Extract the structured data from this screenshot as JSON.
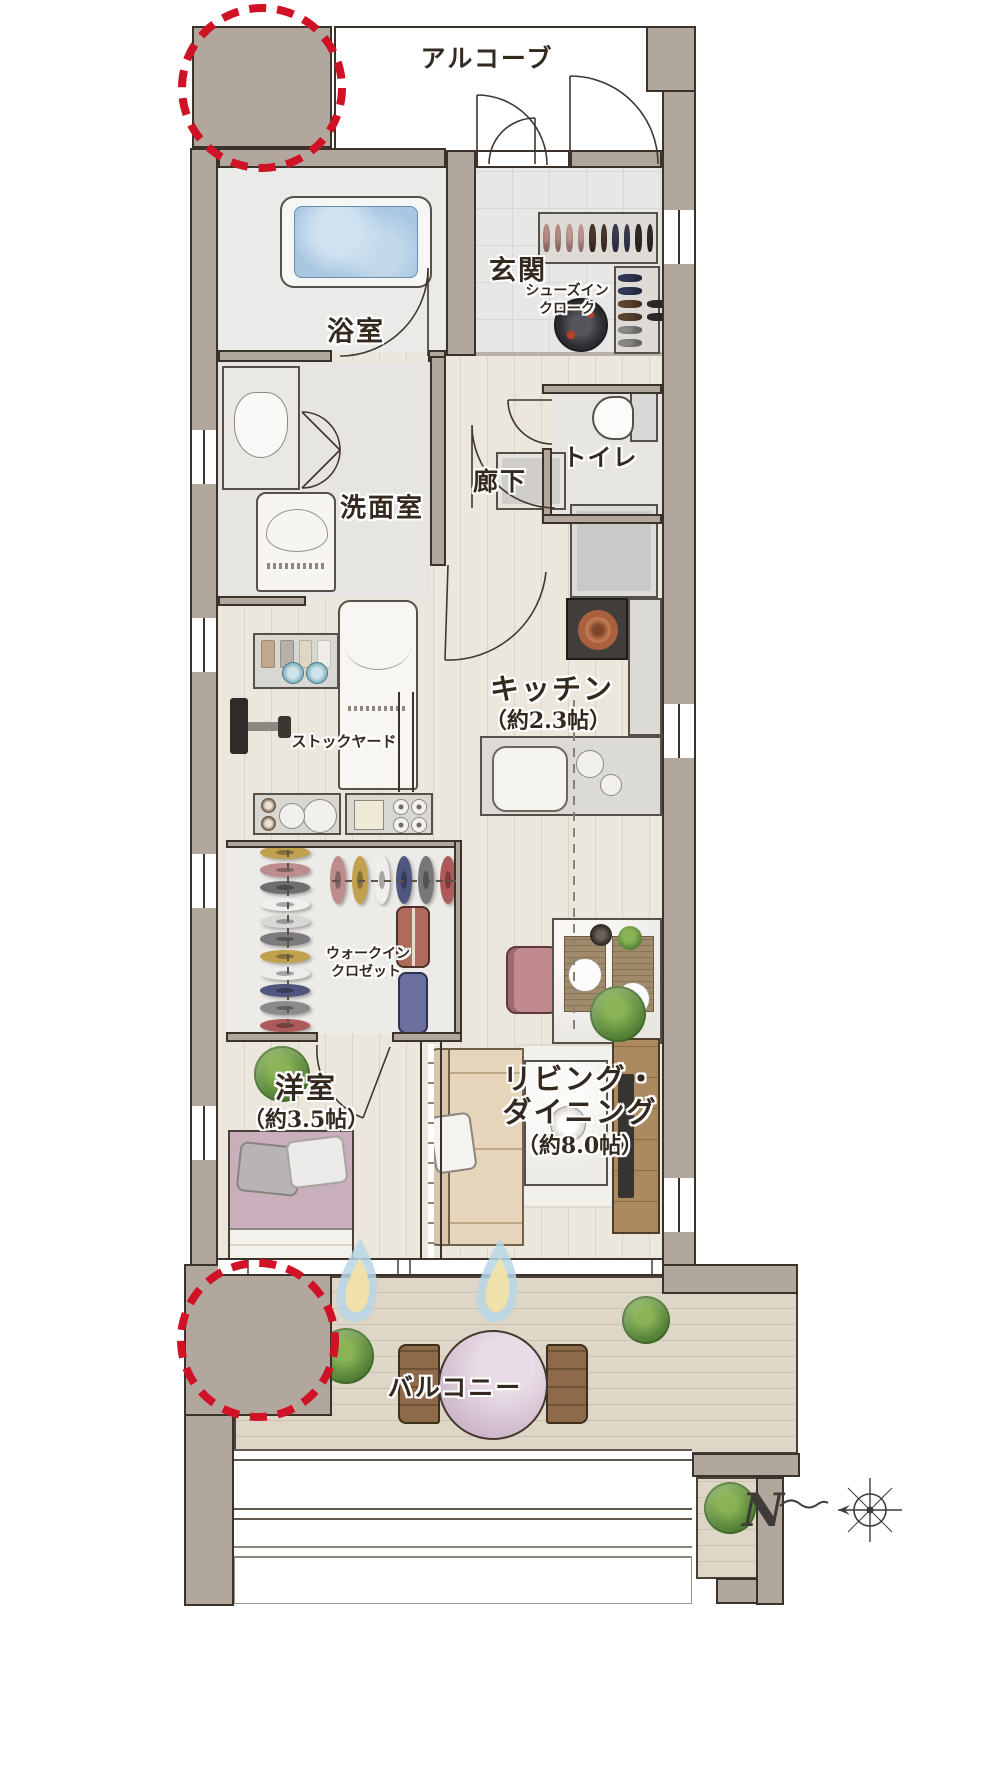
{
  "rooms": {
    "alcove": {
      "label": "アルコーブ"
    },
    "genkan": {
      "label": "玄関"
    },
    "shoes_in_closet": {
      "line1": "シューズイン",
      "line2": "クローク"
    },
    "bathroom": {
      "label": "浴室"
    },
    "washroom": {
      "label": "洗面室"
    },
    "hallway": {
      "label": "廊下"
    },
    "toilet": {
      "label": "トイレ"
    },
    "kitchen": {
      "label": "キッチン",
      "size": "（約2.3帖）"
    },
    "stockyard": {
      "label": "ストックヤード"
    },
    "walk_in_closet": {
      "line1": "ウォークイン",
      "line2": "クロゼット"
    },
    "western_room": {
      "label": "洋室",
      "size": "（約3.5帖）"
    },
    "living_dining": {
      "line1": "リビング・",
      "line2": "ダイニング",
      "size": "（約8.0帖）"
    },
    "balcony": {
      "label": "バルコニー"
    }
  },
  "compass": {
    "north": "N"
  },
  "colors": {
    "wall": "#b2a79c",
    "outline": "#3b322b",
    "annotation_red": "#d01226",
    "bath_water": "#a9c7e2",
    "wood_floor": "#ece7dd",
    "deck": "#ded6c7",
    "bed": "#c9aebb",
    "sofa": "#e6d5ba",
    "dining_chair": "#c2898e",
    "balcony_table": "#cdb7c9"
  },
  "decor": {
    "shoe_rack_top": [
      "#bd918b",
      "#c79d95",
      "#4a372b",
      "#3c3a54",
      "#2f2b28"
    ],
    "shoe_rack_right": [
      "#33395c",
      "#5d4632",
      "#8e8d8b",
      "#2e2b29"
    ],
    "closet_col": [
      "#c2a14e",
      "#bd8d8d",
      "#6e6e70",
      "#f0efed",
      "#d8d8d6",
      "#7c7c7e",
      "#c2a14e",
      "#ececea",
      "#4f5780",
      "#8b8b8d",
      "#ad5a5a"
    ],
    "closet_row": [
      "#bd8d8d",
      "#c2a14e",
      "#efeeec",
      "#4f5780",
      "#77777a",
      "#ad5a5a"
    ],
    "supplies": [
      "#c2a98e",
      "#b5b0a8",
      "#e0d6c4",
      "#efece6"
    ]
  }
}
